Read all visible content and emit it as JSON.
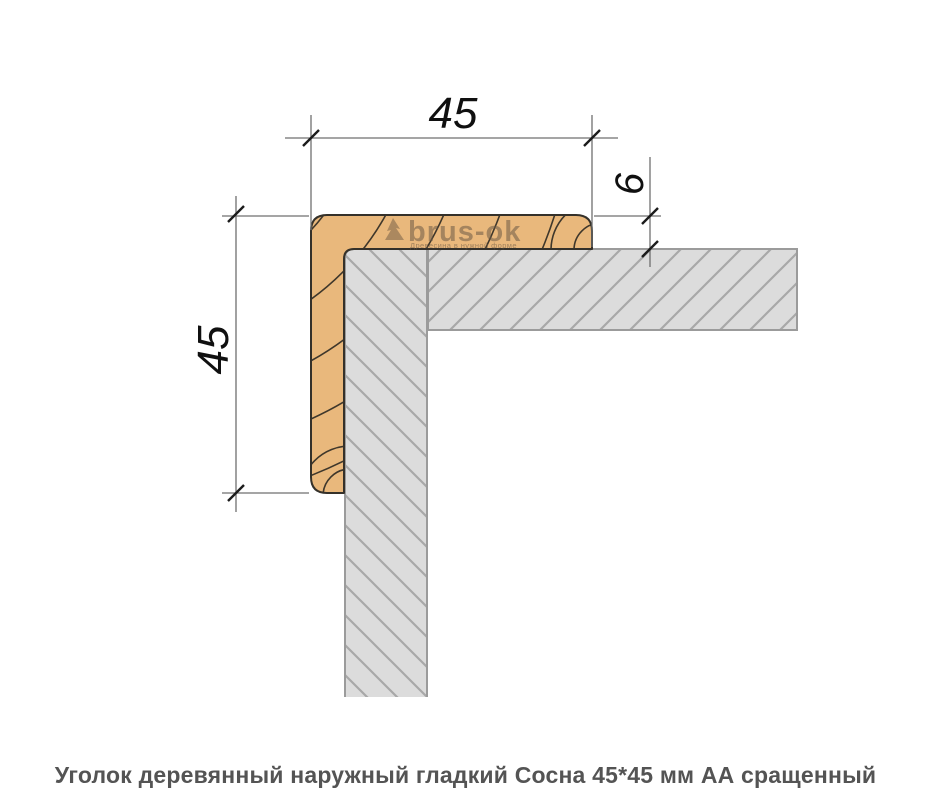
{
  "caption": "Уголок деревянный наружный гладкий Сосна 45*45 мм АА сращенный",
  "drawing": {
    "dim_width_label": "45",
    "dim_height_label": "45",
    "dim_thickness_label": "6",
    "watermark": {
      "brand": "brus-ok",
      "tagline": "Древесина в нужной форме"
    },
    "colors": {
      "wood_fill": "#e9b87c",
      "wood_line": "#35312a",
      "wall_fill": "#dcdcdc",
      "wall_border": "#9b9b9b",
      "hatch_line": "#a8a8a8",
      "dim_line": "#6f6f6f",
      "tick": "#1b1b1b",
      "dim_text": "#101010",
      "caption_text": "#545454"
    }
  }
}
